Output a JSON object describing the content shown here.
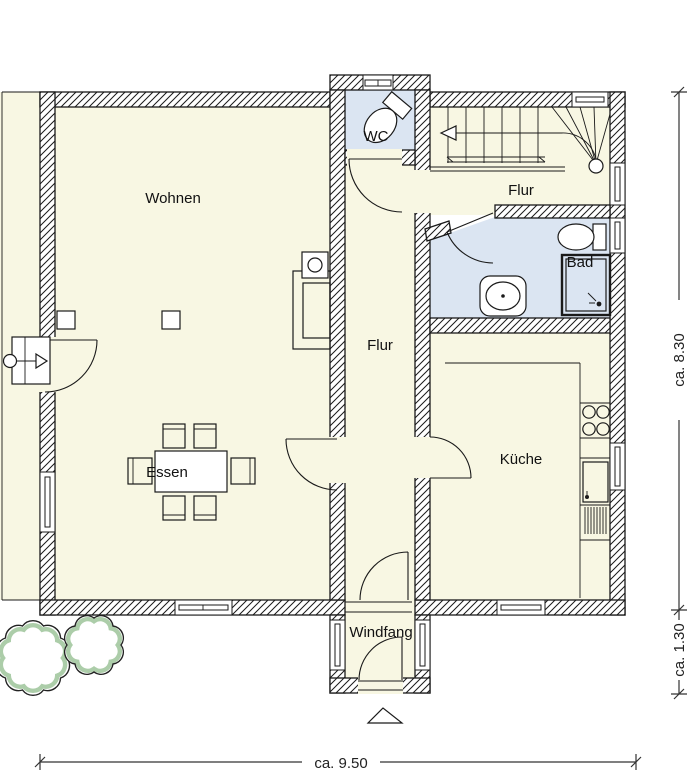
{
  "colors": {
    "room_fill": "#f8f7e3",
    "wet_room_fill": "#dbe5f2",
    "wall_line": "#1a1a1a",
    "tree_green": "#9dc49a",
    "background": "#ffffff"
  },
  "rooms": {
    "wohnen": {
      "label": "Wohnen"
    },
    "essen": {
      "label": "Essen"
    },
    "wc": {
      "label": "WC"
    },
    "flur_upper": {
      "label": "Flur"
    },
    "flur_corridor": {
      "label": "Flur"
    },
    "bad": {
      "label": "Bad"
    },
    "kueche": {
      "label": "Küche"
    },
    "windfang": {
      "label": "Windfang"
    }
  },
  "dimensions": {
    "depth": "ca. 8.30",
    "entry_depth": "ca. 1.30",
    "width": "ca. 9.50"
  }
}
